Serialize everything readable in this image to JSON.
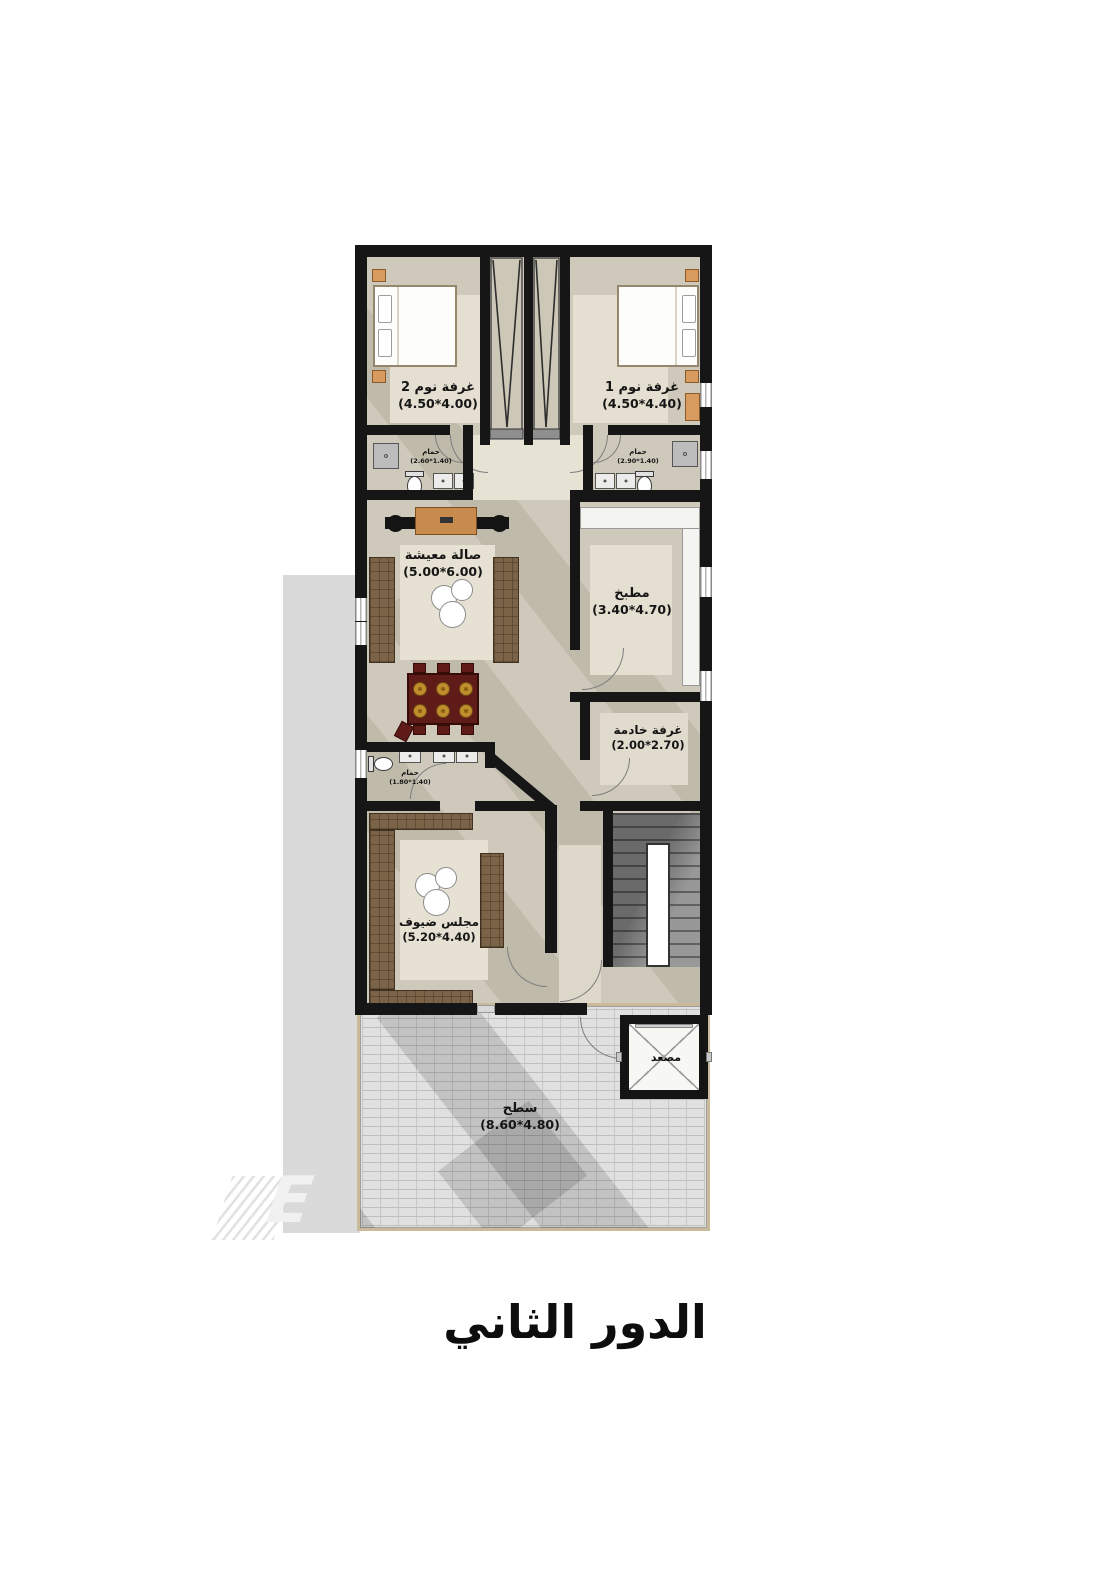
{
  "title": {
    "text": "الدور الثاني"
  },
  "watermark": {
    "letter": "E"
  },
  "rooms": {
    "bedroom2": {
      "name": "غرفة نوم 2",
      "dims": "(4.50*4.00)"
    },
    "bedroom1": {
      "name": "غرفة نوم 1",
      "dims": "(4.50*4.40)"
    },
    "bath2": {
      "name": "حمام",
      "dims": "(2.60*1.40)"
    },
    "bath1": {
      "name": "حمام",
      "dims": "(2.90*1.40)"
    },
    "living": {
      "name": "صالة معيشة",
      "dims": "(5.00*6.00)"
    },
    "kitchen": {
      "name": "مطبخ",
      "dims": "(3.40*4.70)"
    },
    "maid": {
      "name": "غرفة خادمة",
      "dims": "(2.00*2.70)"
    },
    "bath3": {
      "name": "حمام",
      "dims": "(1.80*1.40)"
    },
    "majlis": {
      "name": "مجلس ضيوف",
      "dims": "(5.20*4.40)"
    },
    "roof": {
      "name": "سطح",
      "dims": "(8.60*4.80)"
    },
    "elevator": {
      "name": "مصعد"
    }
  },
  "colors": {
    "wall": "#161616",
    "floor": "#cfc9bb",
    "floor_light": "#e8e4d6",
    "sofa_wood": "#7b6348",
    "tv_wood": "#c98a4e",
    "dining_table": "#5e1b17",
    "plate_gold": "#c08d2c",
    "nightstand_tan": "#d79a5f",
    "terrace_brick": "#e0e0e0"
  }
}
